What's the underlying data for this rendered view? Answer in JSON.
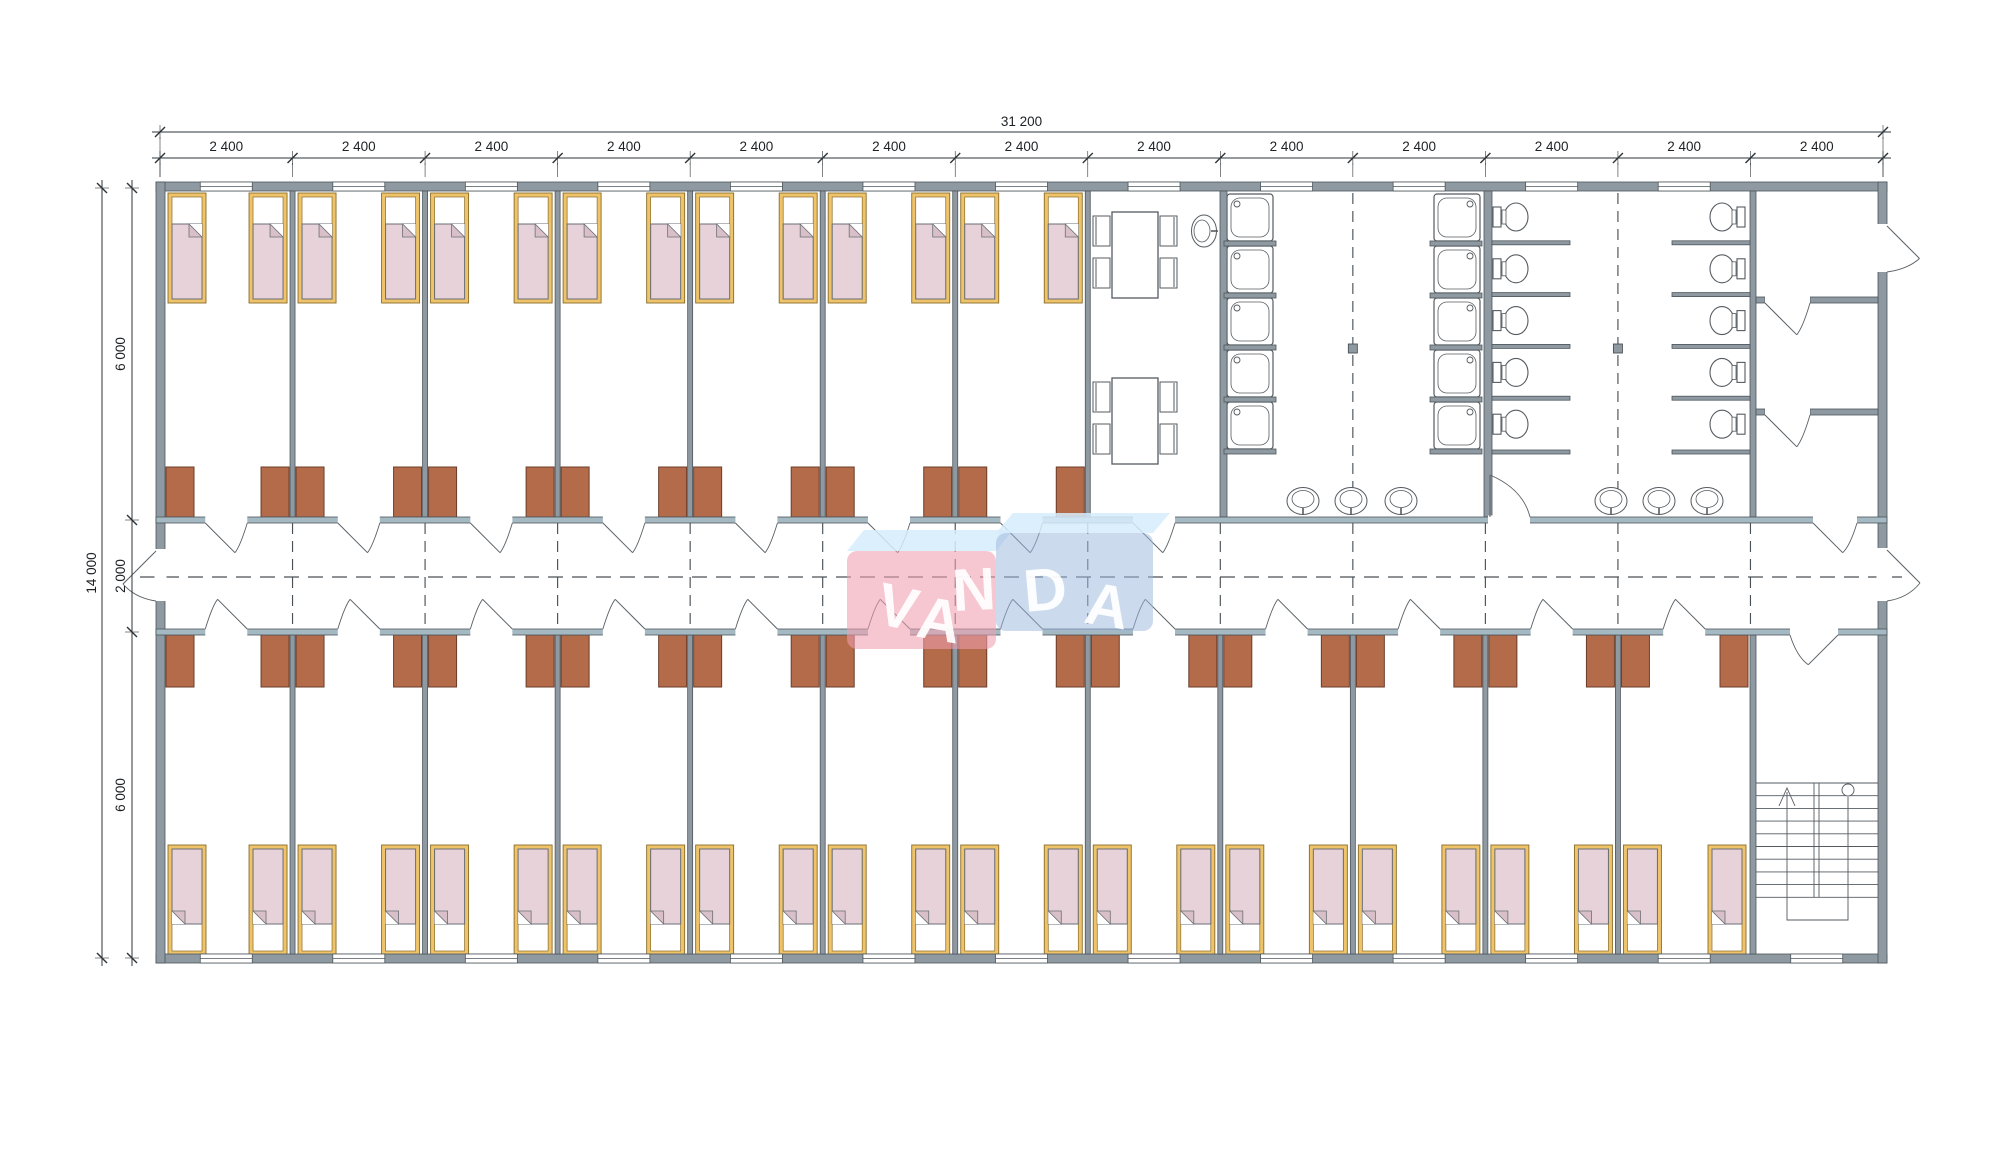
{
  "watermark": {
    "text": "VANDA",
    "letters": [
      {
        "ch": "V",
        "x": 893,
        "y": 627,
        "r": 13
      },
      {
        "ch": "A",
        "x": 936,
        "y": 640,
        "r": 10
      },
      {
        "ch": "N",
        "x": 975,
        "y": 610,
        "r": -3
      },
      {
        "ch": "D",
        "x": 1047,
        "y": 610,
        "r": -5
      },
      {
        "ch": "A",
        "x": 1104,
        "y": 626,
        "r": 10
      }
    ],
    "colors": {
      "red_face": "#ef9fae",
      "blue_face": "#9db9dd",
      "lid": "#d6ecfb",
      "text": "#ffffff"
    }
  },
  "dimensions": {
    "top": {
      "total": "31 200",
      "modules": [
        "2 400",
        "2 400",
        "2 400",
        "2 400",
        "2 400",
        "2 400",
        "2 400",
        "2 400",
        "2 400",
        "2 400",
        "2 400",
        "2 400",
        "2 400"
      ]
    },
    "left": {
      "total": "14 000",
      "segments": [
        "6 000",
        "2 000",
        "6 000"
      ]
    }
  },
  "plan": {
    "module_count": 13,
    "zones": [
      {
        "name": "bedrooms-top",
        "rooms": 7,
        "beds_per_room": 2,
        "wardrobes_per_room": 2
      },
      {
        "name": "dining",
        "tables": 2,
        "chairs": 8,
        "wash_basins": 1
      },
      {
        "name": "washroom",
        "shower_trays": 10,
        "toilets": 10,
        "wash_basins": 6
      },
      {
        "name": "entry-vestibule",
        "rooms": 3,
        "exterior_doors": 1
      },
      {
        "name": "corridor",
        "exterior_doors": 2
      },
      {
        "name": "bedrooms-bottom",
        "rooms": 12,
        "beds_per_room": 2,
        "wardrobes_per_room": 2
      },
      {
        "name": "staircase",
        "flights": 2
      }
    ],
    "colors": {
      "wall": "#8f99a1",
      "corridor_wall": "#a5b9c2",
      "wall_edge": "#4d565c",
      "wardrobe": "#b36b4a",
      "wardrobe_edge": "#6b3d2a",
      "bed_frame": "#eec36a",
      "bed_frame_edge": "#8a6c28",
      "blanket": "#e6d2d8",
      "blanket_fold": "#d9c0c8",
      "blanket_edge": "#6a6f74",
      "fixture_line": "#555b60",
      "door_line": "#5a6166",
      "dash_line": "#4a5156",
      "dim_line": "#2e3438",
      "dim_text": "#1d2124"
    }
  }
}
